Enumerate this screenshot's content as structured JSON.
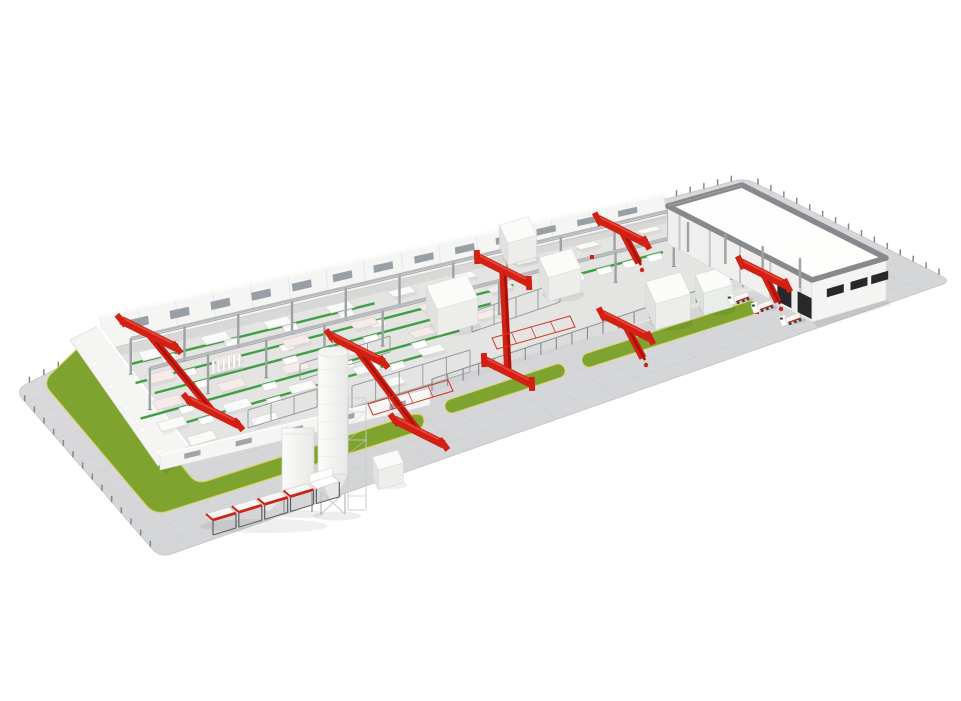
{
  "colors": {
    "background": "#ffffff",
    "ground_light": "#dededf",
    "ground_dark": "#d0d1d3",
    "ground_grid": "#c7c8cb",
    "fence_dark": "#85878a",
    "grass": "#7ea32e",
    "curb": "#d5d352",
    "floor": "#e4e4e3",
    "wall_white": "#f5f5f3",
    "wall_top": "#fbfbfa",
    "wall_shade": "#e3e3e1",
    "window_gray": "#8f979c",
    "column_gray": "#9fa2a5",
    "beam_gray": "#b7b9bb",
    "steel_dark": "#5d6063",
    "frame_gray": "#9a9da0",
    "conveyor_green": "#3f9f45",
    "crane_red": "#d32014",
    "crane_dark": "#a31309",
    "crane_highlight": "#e4473a",
    "table_white": "#fafaf9",
    "table_pink": "#f7ebe9",
    "table_edge": "#d6d6d4",
    "machine_top": "#fbfbfa",
    "machine_front": "#ededeb",
    "machine_side": "#e1e1df",
    "machine_green": "#e9eee8",
    "roof_white": "#fdfdfc",
    "parapet_gray": "#87898c",
    "slot_dark": "#26282a",
    "silo_white": "#fcfcfb",
    "silo_shade": "#e8e8e6"
  },
  "scene": {
    "ground": {
      "w": [
        15,
        390
      ],
      "s": [
        160,
        558
      ],
      "e": [
        952,
        281
      ],
      "n": [
        745,
        178
      ],
      "bend": [
        87,
        353
      ],
      "corner_r": 12,
      "grid_u": 14,
      "grid_v": 26,
      "tick_spacing": 14,
      "tick_h": 6
    },
    "grass": {
      "band_west_path": "M 78,348 L 50,375 Q 44,383 49,390 L 146,505 Q 153,514 165,512 L 410,434 Q 423,430 424,421 Q 424,412 411,415 L 207,481 Q 196,484 190,476 L 100,364 Q 94,355 99,349 Z",
      "strips": [
        {
          "from": [
            452,
            406
          ],
          "to": [
            558,
            371
          ],
          "w": 13
        },
        {
          "from": [
            589,
            360
          ],
          "to": [
            751,
            308
          ],
          "w": 13
        }
      ]
    },
    "hall": {
      "lane_left": [
        [
          104,
          348
        ],
        [
          162,
          460
        ]
      ],
      "lane_right": [
        [
          668,
          214
        ],
        [
          804,
          270
        ]
      ],
      "floor": [
        [
          104,
          348
        ],
        [
          700,
          210
        ],
        [
          820,
          272
        ],
        [
          162,
          460
        ]
      ],
      "back_wall": {
        "top_from": [
          100,
          316
        ],
        "top_to": [
          664,
          194
        ],
        "bot_from": [
          104,
          350
        ],
        "bot_to": [
          666,
          216
        ],
        "panels": 15,
        "windows": 13
      },
      "west_wall": {
        "poly": [
          [
            70,
            340
          ],
          [
            98,
            326
          ],
          [
            188,
            446
          ],
          [
            158,
            466
          ]
        ],
        "buttress_from": [
          74,
          342
        ],
        "buttress_to": [
          154,
          452
        ],
        "buttresses": 6
      },
      "front_wall": {
        "top_from": [
          160,
          455
        ],
        "top_to": [
          430,
          390
        ],
        "h": 15,
        "slots": 5
      },
      "fence": {
        "from": [
          432,
          391
        ],
        "to": [
          774,
          277
        ],
        "post_spacing": 16,
        "post_h": 12
      }
    },
    "column_rows": [
      {
        "t": 0.26,
        "u0": 0.02,
        "u1": 0.94,
        "n": 11,
        "h_left": 36,
        "h_right": 27
      },
      {
        "t": 0.58,
        "u0": 0.02,
        "u1": 0.88,
        "n": 10,
        "h_left": 42,
        "h_right": 30
      }
    ],
    "conveyors": [
      {
        "t": 0.18,
        "u0": 0.03,
        "u1": 0.45
      },
      {
        "t": 0.34,
        "u0": 0.02,
        "u1": 0.66
      },
      {
        "t": 0.46,
        "u0": 0.04,
        "u1": 0.6
      },
      {
        "t": 0.63,
        "u0": 0.0,
        "u1": 0.52
      },
      {
        "t": 0.76,
        "u0": 0.03,
        "u1": 0.45
      },
      {
        "t": 0.4,
        "u0": 0.72,
        "u1": 0.9
      }
    ],
    "pallet_fracs": [
      0.12,
      0.38,
      0.62,
      0.85
    ],
    "table_rows": [
      {
        "t": 0.1,
        "u0": 0.05,
        "u1": 0.92,
        "n": 9,
        "tint": "white"
      },
      {
        "t": 0.3,
        "u0": 0.04,
        "u1": 0.62,
        "n": 6,
        "tint": "pink"
      },
      {
        "t": 0.52,
        "u0": 0.03,
        "u1": 0.56,
        "n": 6,
        "tint": "pink"
      },
      {
        "t": 0.7,
        "u0": 0.02,
        "u1": 0.44,
        "n": 5,
        "tint": "white"
      },
      {
        "t": 0.88,
        "u0": 0.05,
        "u1": 0.35,
        "n": 4,
        "tint": "white"
      }
    ],
    "steel_frames": [
      {
        "from": [
          352,
          408
        ],
        "to": [
          470,
          372
        ],
        "h": 22,
        "n": 6
      },
      {
        "from": [
          472,
          332
        ],
        "to": [
          560,
          302
        ],
        "h": 20,
        "n": 5
      },
      {
        "from": [
          248,
          428
        ],
        "to": [
          340,
          400
        ],
        "h": 18,
        "n": 5
      },
      {
        "from": [
          300,
          380
        ],
        "to": [
          390,
          352
        ],
        "h": 16,
        "n": 5
      }
    ],
    "battery_mold": {
      "at": [
        212,
        374
      ],
      "fins": 6
    },
    "machines": [
      {
        "at": [
          452,
          318
        ],
        "w": 42,
        "d": 26,
        "h": 26,
        "tint": "white"
      },
      {
        "at": [
          560,
          287
        ],
        "w": 34,
        "d": 22,
        "h": 24,
        "tint": "white"
      },
      {
        "at": [
          518,
          252
        ],
        "w": 30,
        "d": 20,
        "h": 22,
        "tint": "white"
      },
      {
        "at": [
          668,
          314
        ],
        "w": 36,
        "d": 24,
        "h": 26,
        "tint": "white"
      },
      {
        "at": [
          714,
          302
        ],
        "w": 30,
        "d": 20,
        "h": 22,
        "tint": "green"
      }
    ],
    "warehouse": {
      "roof": [
        [
          668,
          206
        ],
        [
          742,
          185
        ],
        [
          886,
          258
        ],
        [
          812,
          280
        ]
      ],
      "parapet_w": 5.5,
      "se_wall": [
        [
          812,
          280
        ],
        [
          886,
          258
        ],
        [
          886,
          300
        ],
        [
          812,
          322
        ]
      ],
      "se_slots": [
        0.2,
        0.52,
        0.8
      ],
      "sw_wall": [
        [
          668,
          206
        ],
        [
          812,
          280
        ],
        [
          812,
          322
        ],
        [
          668,
          244
        ]
      ],
      "sw_cols": 5,
      "sw_doors": [
        0.76,
        0.9
      ],
      "canopy_cols": {
        "from": [
          688,
          252
        ],
        "to": [
          800,
          288
        ],
        "n": 4,
        "h": 30
      }
    },
    "cranes": [
      {
        "kind": "I",
        "a": [
          149,
          334
        ],
        "b": [
          213,
          412
        ],
        "len": 31
      },
      {
        "kind": "I",
        "a": [
          357,
          349
        ],
        "b": [
          419,
          432
        ],
        "len": 30
      },
      {
        "kind": "I",
        "a": [
          503,
          270
        ],
        "b": [
          508,
          372
        ],
        "len": 29
      },
      {
        "kind": "T",
        "a": [
          622,
          231
        ],
        "b": [
          639,
          263
        ],
        "len": 27
      },
      {
        "kind": "T",
        "a": [
          626,
          326
        ],
        "b": [
          643,
          358
        ],
        "len": 27
      },
      {
        "kind": "T",
        "a": [
          764,
          274
        ],
        "b": [
          778,
          302
        ],
        "len": 26
      }
    ],
    "red_dots": [
      [
        592,
        257
      ],
      [
        757,
        312
      ]
    ],
    "red_racks": [
      {
        "from": [
          492,
          338
        ],
        "to": [
          570,
          316
        ],
        "d": 14
      },
      {
        "from": [
          368,
          404
        ],
        "to": [
          448,
          380
        ],
        "d": 16
      }
    ],
    "silo": {
      "x": 318,
      "y": 352,
      "wd": 30,
      "hb": 122,
      "cone": 24,
      "leg_h": 16,
      "tower": [
        348,
        398,
        18,
        112
      ]
    },
    "hopper": {
      "x": 282,
      "y": 428,
      "wd": 32,
      "ht": 64,
      "leg_h": 20
    },
    "cabinet": {
      "at": [
        388,
        480
      ],
      "w": 26,
      "d": 14,
      "h": 20
    },
    "bin_row": {
      "origin": [
        206,
        514
      ],
      "spacing": 27,
      "bins": 4,
      "bin_w": 24,
      "leg_h": 15
    },
    "trucks": [
      [
        733,
        297
      ],
      [
        757,
        305
      ],
      [
        785,
        318
      ]
    ]
  }
}
